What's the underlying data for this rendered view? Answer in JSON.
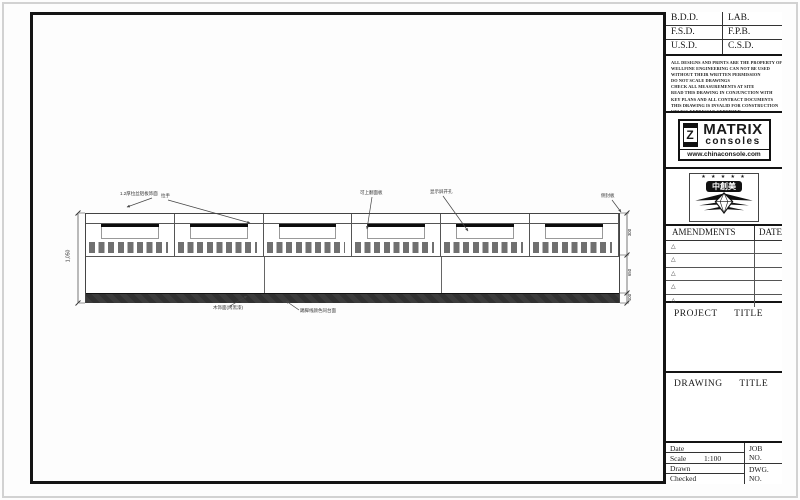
{
  "colors": {
    "frame": "#141414",
    "plinth": "#3a3a3a",
    "vent_slat": "#707070",
    "screen_bar": "#0c0c0c",
    "paper": "#fdfdfd"
  },
  "title_block": {
    "signatures": {
      "labels": [
        "B.D.D.",
        "LAB.",
        "F.S.D.",
        "F.P.B.",
        "U.S.D.",
        "C.S.D."
      ]
    },
    "disclaimer": {
      "lines": [
        "ALL DESIGNS AND PRINTS ARE THE PROPERTY OF",
        "WELLFINE ENGINEERING CAN NOT BE USED",
        "WITHOUT THEIR WRITTEN PERMISSION",
        "DO NOT SCALE DRAWINGS",
        "CHECK ALL MEASUREMENTS AT SITE",
        "READ THIS DRAWING IN CONJUNCTION WITH",
        "KEY PLANS AND ALL CONTRACT DOCUMENTS",
        "THIS DRAWING IS INVALID FOR CONSTRUCTION",
        "UNLESS EXPRESSLY CERTIFIED"
      ]
    },
    "matrix_logo": {
      "icon_letter": "Z",
      "name": "MATRIX",
      "subtitle": "consoles",
      "url": "www.chinaconsole.com"
    },
    "emblem": {
      "stars": "★ ★ ★ ★ ★",
      "text": "中創美"
    },
    "amendments": {
      "header": "AMENDMENTS",
      "date_header": "DATE",
      "rows": [
        {
          "symbol": "△",
          "date": ""
        },
        {
          "symbol": "△",
          "date": ""
        },
        {
          "symbol": "△",
          "date": ""
        },
        {
          "symbol": "△",
          "date": ""
        },
        {
          "symbol": "△",
          "date": ""
        }
      ]
    },
    "project": {
      "label": "PROJECT TITLE"
    },
    "drawing_title": {
      "label": "DRAWING TITLE"
    },
    "info": {
      "date_label": "Date",
      "scale_label": "Scale",
      "scale_value": "1:100",
      "drawn_label": "Drawn",
      "checked_label": "Checked",
      "job_label": "JOB NO.",
      "dwg_label": "DWG. NO."
    }
  },
  "drawing": {
    "description": "Front elevation of a 6-bay control console with monitor slots, vent slats and dark plinth",
    "dimensions": {
      "total_height": "1,050",
      "right_segments": [
        "300",
        "650",
        "100"
      ]
    },
    "annotations": {
      "top": [
        {
          "text": "1.2厚拉丝铝板饰面"
        },
        {
          "text": "拉手"
        },
        {
          "text": "可上翻面板"
        },
        {
          "text": "显示屏开孔"
        },
        {
          "text": "侧封板"
        }
      ],
      "bottom": [
        {
          "text": "木饰面(烤黑漆)"
        },
        {
          "text": "踢脚线颜色同台面"
        }
      ]
    }
  }
}
